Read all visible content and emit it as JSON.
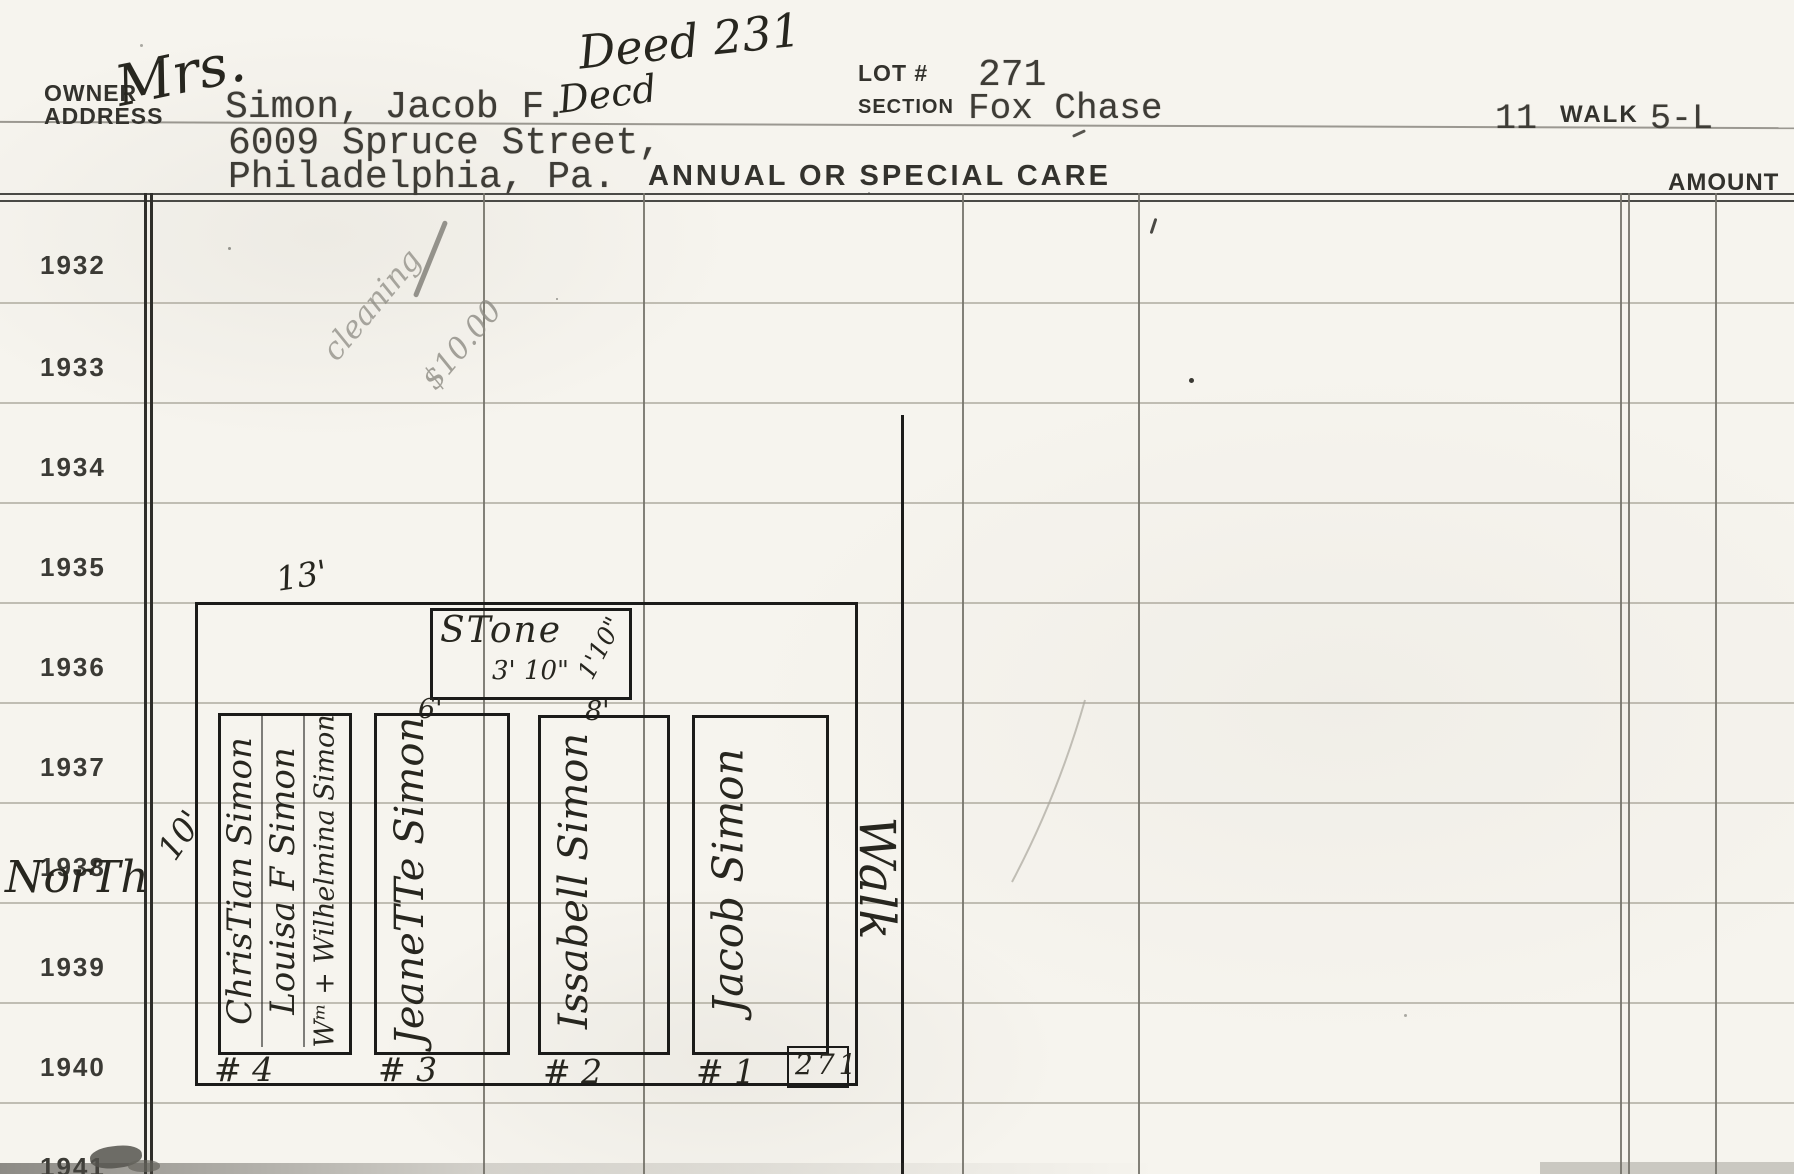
{
  "header": {
    "owner_label": "OWNER",
    "address_label": "ADDRESS",
    "owner_prefix_handwritten": "Mrs.",
    "owner_name": "Simon, Jacob F.",
    "owner_suffix_handwritten": "Decd",
    "address_line1": "6009 Spruce Street,",
    "address_line2": "Philadelphia, Pa.",
    "deed_note_handwritten": "Deed 231",
    "lot_label": "LOT #",
    "lot_number": "271",
    "section_label": "SECTION",
    "section_value": "Fox Chase",
    "walk_left_value": "11",
    "walk_label": "WALK",
    "walk_right_value": "5-L",
    "care_title": "ANNUAL OR SPECIAL CARE",
    "amount_label": "AMOUNT"
  },
  "pencil_note": {
    "line1": "cleaning",
    "line2": "$10.00"
  },
  "years": [
    "1932",
    "1933",
    "1934",
    "1935",
    "1936",
    "1937",
    "1938",
    "1939",
    "1940",
    "1941"
  ],
  "north_handwritten": "NorTh",
  "diagram": {
    "width_label": "13'",
    "depth_label": "10'",
    "stone": {
      "label": "STone",
      "width_label": "3' 10\"",
      "height_label": "1'10\""
    },
    "tick_left": "6'",
    "tick_right": "8'",
    "plots": [
      {
        "number": "# 4",
        "names": [
          "ChrisTian Simon",
          "Louisa F Simon",
          "Wᵐ + Wilhelmina Simon"
        ]
      },
      {
        "number": "# 3",
        "names": [
          "JeaneTTe Simon"
        ]
      },
      {
        "number": "# 2",
        "names": [
          "Issabell Simon"
        ]
      },
      {
        "number": "# 1",
        "names": [
          "Jacob Simon"
        ]
      }
    ],
    "lot_number_box": "271",
    "walk_handwritten": "Walk"
  },
  "colors": {
    "paper": "#f6f4ee",
    "ink": "#1b1b19",
    "typed_ink": "#3e3c36",
    "rule_line": "#b3afa4",
    "pencil": "#8e8c84"
  }
}
